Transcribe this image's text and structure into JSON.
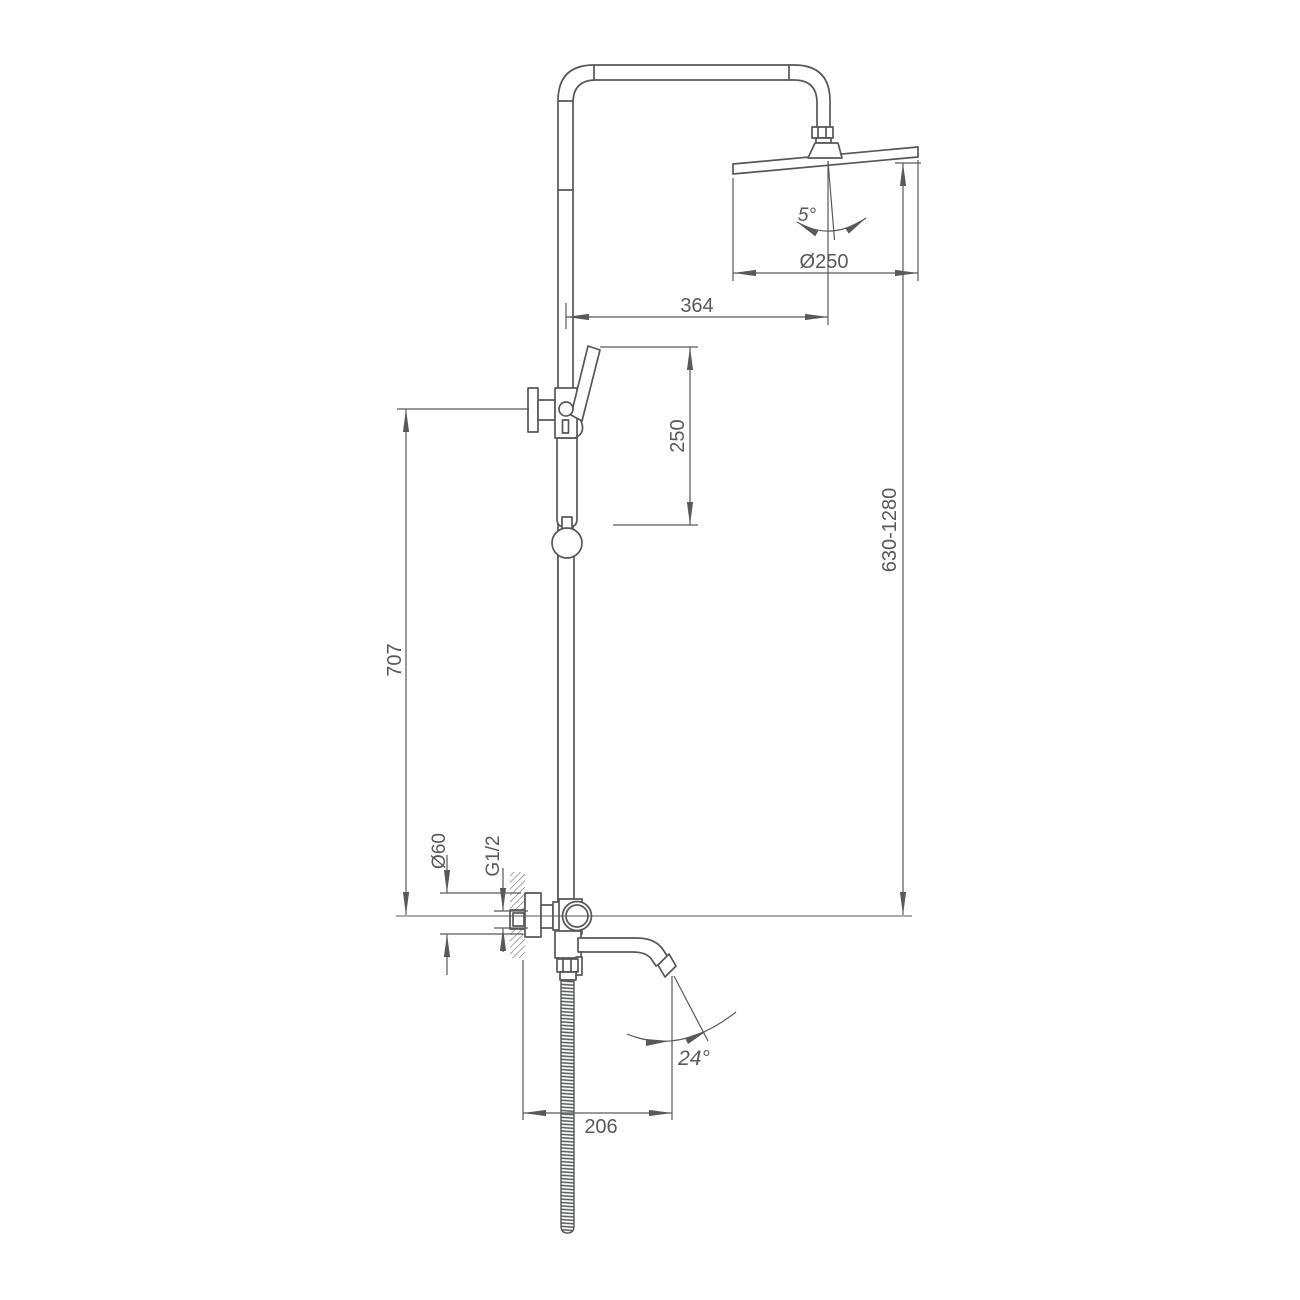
{
  "drawing": {
    "kind": "technical dimension drawing",
    "subject": "exposed shower column with rain head, hand shower and swivel tub spout",
    "line_color": "#58595b",
    "background_color": "#ffffff"
  },
  "labels": {
    "arm_reach": "364",
    "head_diameter": "Ø250",
    "head_angle": "5°",
    "height_range": "630-1280",
    "hand_shower_travel": "250",
    "holder_height": "707",
    "escutcheon_diameter": "Ø60",
    "thread": "G1/2",
    "spout_reach": "206",
    "spout_angle": "24°"
  }
}
